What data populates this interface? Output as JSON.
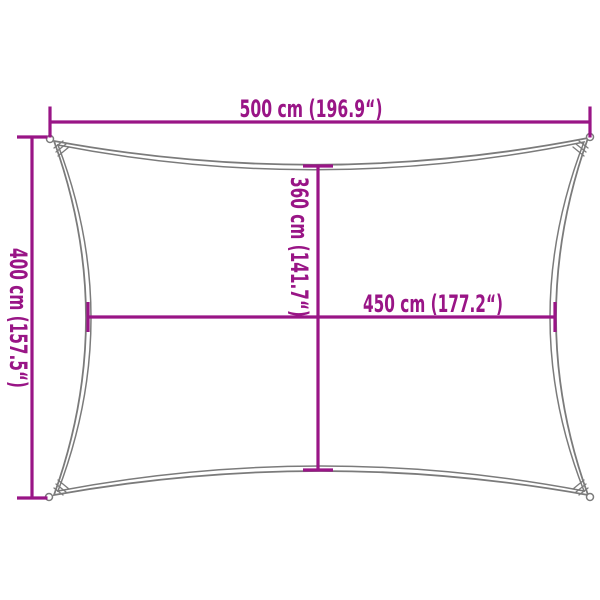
{
  "diagram": {
    "title": "shade-sail-dimension-diagram",
    "labels": {
      "total_width": "500 cm (196.9“)",
      "total_height": "400 cm (157.5“)",
      "inner_height": "360 cm (141.7“)",
      "inner_width": "450 cm (177.2“)"
    },
    "colors": {
      "dimension": "#991586",
      "outline": "#7b7b7b",
      "background": "#ffffff"
    }
  }
}
